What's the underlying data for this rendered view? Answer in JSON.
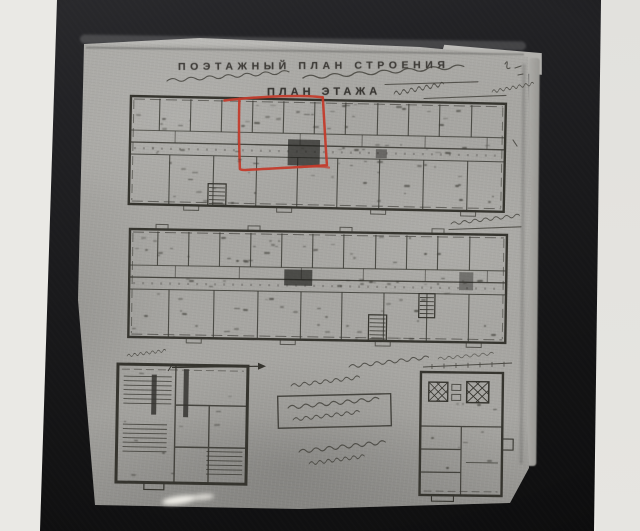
{
  "header": {
    "line1": "ПОЭТАЖНЫЙ ПЛАН СТРОЕНИЯ",
    "line3": "ПЛАН ЭТАЖА"
  },
  "colors": {
    "page_background": "#eae9e5",
    "photo_background": "#1a1a1c",
    "paper": "#a7a6a2",
    "ink": "#35342e",
    "red_annotation": "#c33b2b"
  }
}
